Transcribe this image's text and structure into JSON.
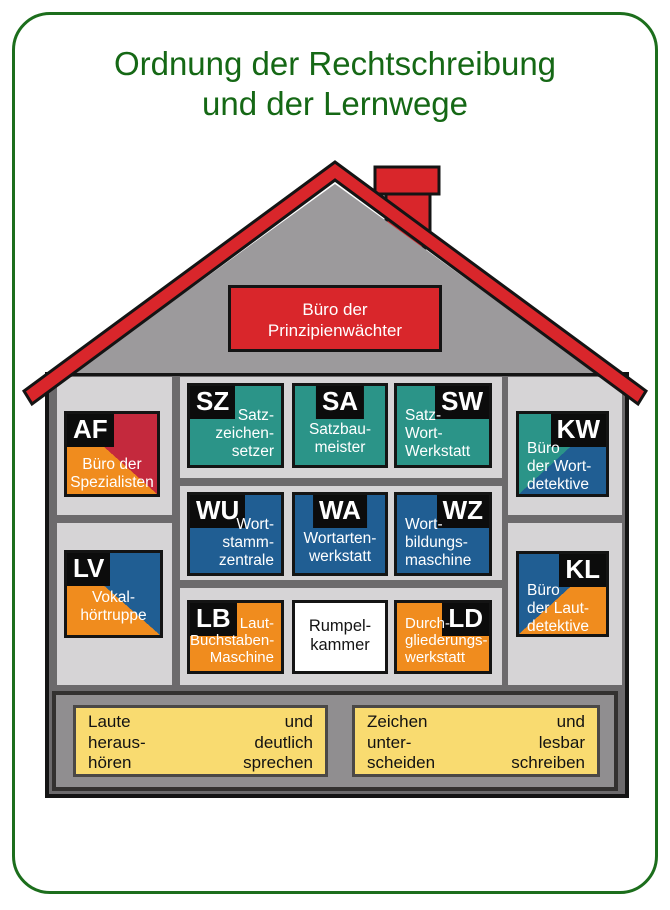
{
  "title": {
    "line1": "Ordnung der Rechtschreibung",
    "line2": "und der Lernwege"
  },
  "roof_office": {
    "line1": "Büro der",
    "line2": "Prinzipienwächter"
  },
  "rooms": {
    "af": {
      "code": "AF",
      "line1": "Büro der",
      "line2": "Spezialisten"
    },
    "lv": {
      "code": "LV",
      "line1": "Vokal-",
      "line2": "hörtruppe"
    },
    "sz": {
      "code": "SZ",
      "line1": "Satz-",
      "line2": "zeichen-",
      "line3": "setzer"
    },
    "sa": {
      "code": "SA",
      "line1": "Satzbau-",
      "line2": "meister"
    },
    "sw": {
      "code": "SW",
      "line1": "Satz-",
      "line2": "Wort-",
      "line3": "Werkstatt"
    },
    "wu": {
      "code": "WU",
      "line1": "Wort-",
      "line2": "stamm-",
      "line3": "zentrale"
    },
    "wa": {
      "code": "WA",
      "line1": "Wortarten-",
      "line2": "werkstatt"
    },
    "wz": {
      "code": "WZ",
      "line1": "Wort-",
      "line2": "bildungs-",
      "line3": "maschine"
    },
    "lb": {
      "code": "LB",
      "line1": "Laut-",
      "line2": "Buchstaben-",
      "line3": "Maschine"
    },
    "rk": {
      "line1": "Rumpel-",
      "line2": "kammer"
    },
    "ld": {
      "code": "LD",
      "line1": "Durch-",
      "line2": "gliederungs-",
      "line3": "werkstatt"
    },
    "kw": {
      "code": "KW",
      "line1": "Büro",
      "line2": "der Wort-",
      "line3": "detektive"
    },
    "kl": {
      "code": "KL",
      "line1": "Büro",
      "line2": "der Laut-",
      "line3": "detektive"
    }
  },
  "foundation": {
    "left_box": {
      "left": {
        "line1": "Laute",
        "line2": "heraus-",
        "line3": "hören"
      },
      "right": {
        "line1": "und",
        "line2": "deutlich",
        "line3": "sprechen"
      }
    },
    "right_box": {
      "left": {
        "line1": "Zeichen",
        "line2": "unter-",
        "line3": "scheiden"
      },
      "right": {
        "line1": "und",
        "line2": "lesbar",
        "line3": "schreiben"
      }
    }
  },
  "colors": {
    "title_green": "#156815",
    "frame_green": "#1C6E1C",
    "roof_red": "#D9262B",
    "crimson": "#C4293D",
    "teal": "#2B9488",
    "blue": "#205E93",
    "orange": "#F08C1E",
    "yellow": "#F9DB70",
    "wall_gray": "#6C6A6C",
    "panel_gray": "#D6D4D6",
    "gable_gray": "#9C9A9C",
    "basement_gray": "#908E90",
    "label_black": "#0C0C0C"
  }
}
